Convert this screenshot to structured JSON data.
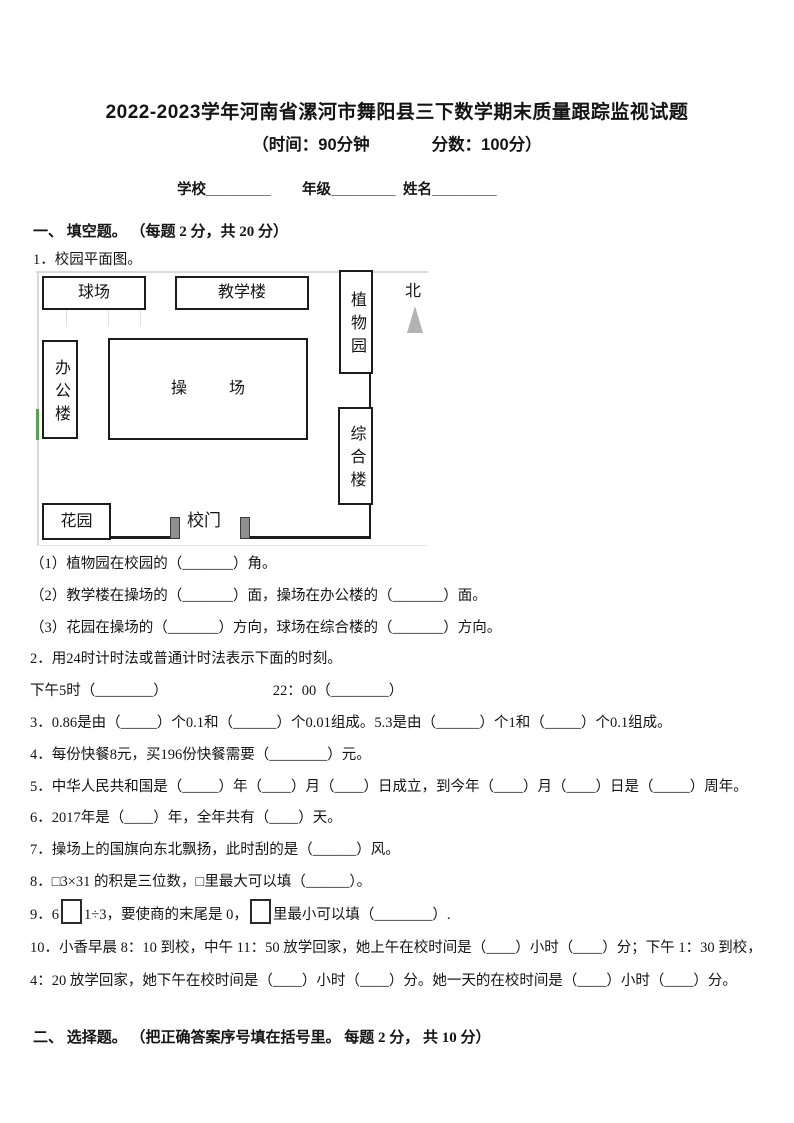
{
  "header": {
    "title": "2022-2023学年河南省漯河市舞阳县三下数学期末质量跟踪监视试题",
    "time_label": "（时间：90分钟",
    "score_label": "分数：100分）",
    "school_field": "学校________",
    "grade_field": "年级________",
    "name_field": "姓名________"
  },
  "section_one": {
    "heading": "一、 填空题。 （每题 2 分，共 20 分）",
    "q1_lead": "1．校园平面图。",
    "map": {
      "north_label": "北",
      "ball_field": "球场",
      "teaching_building": "教学楼",
      "botanical_garden": "植物园",
      "office_building": "办公楼",
      "playground": "操场",
      "complex_building": "综合楼",
      "garden": "花园",
      "school_gate": "校门",
      "accent_green": "#55a352",
      "arrow_gray": "#b3b3b3"
    },
    "q1_sub1": "（1）植物园在校园的（_______）角。",
    "q1_sub2": "（2）教学楼在操场的（_______）面，操场在办公楼的（_______）面。",
    "q1_sub3": "（3）花园在操场的（_______）方向，球场在综合楼的（_______）方向。",
    "q2": "2．用24时计时法或普通计时法表示下面的时刻。",
    "q2_blank1": "下午5时（________）",
    "q2_blank2": "22：00（________）",
    "q3": "3．0.86是由（_____）个0.1和（______）个0.01组成。5.3是由（______）个1和（_____）个0.1组成。",
    "q4": "4．每份快餐8元，买196份快餐需要（________）元。",
    "q5": "5．中华人民共和国是（_____）年（____）月（____）日成立，到今年（____）月（____）日是（_____）周年。",
    "q6": "6．2017年是（____）年，全年共有（____）天。",
    "q7": "7．操场上的国旗向东北飘扬，此时刮的是（______）风。",
    "q8": "8．□3×31 的积是三位数，□里最大可以填（______）。",
    "q9_part1": "9．6",
    "q9_part2": "1÷3，要使商的末尾是 0，",
    "q9_part3": "里最小可以填（________）.",
    "q10": "10．小香早晨 8：10 到校，中午 11：50 放学回家，她上午在校时间是（____）小时（____）分；下午 1：30 到校，4：20 放学回家，她下午在校时间是（____）小时（____）分。她一天的在校时间是（____）小时（____）分。"
  },
  "section_two": {
    "heading": "二、 选择题。 （把正确答案序号填在括号里。 每题 2 分， 共 10 分）"
  }
}
